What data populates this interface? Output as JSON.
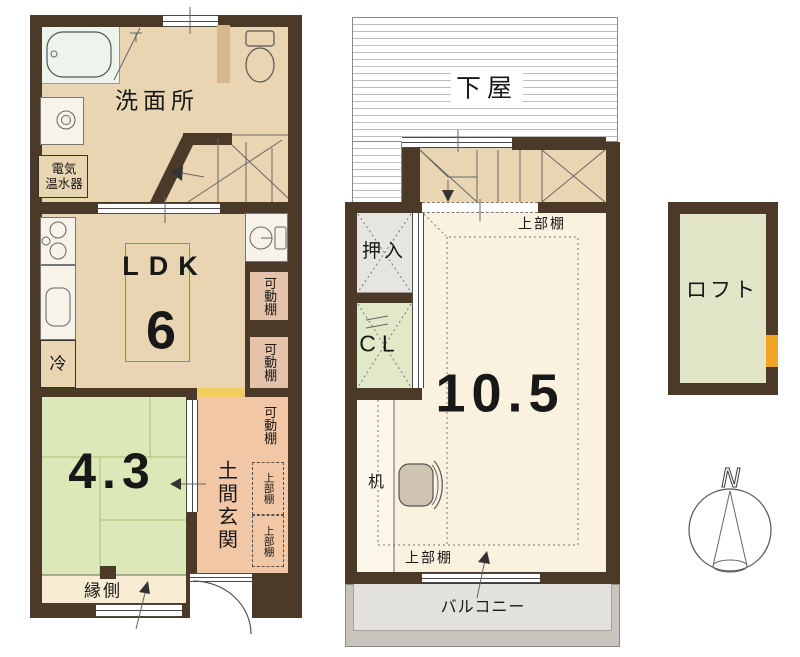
{
  "title": "2-story floor plan with loft",
  "floor1": {
    "washroom": "洗面所",
    "water_heater": {
      "line1": "電気",
      "line2": "温水器"
    },
    "ldk_label": "LDK",
    "ldk_size": "6",
    "fridge": "冷",
    "movable_shelves": [
      "可動棚",
      "可動棚",
      "可動棚"
    ],
    "tatami_size": "4.3",
    "entrance": "土間玄関",
    "upper_shelves": [
      "上部棚",
      "上部棚"
    ],
    "veranda": "縁側"
  },
  "floor2": {
    "lower_roof": "下屋",
    "upper_shelf_top": "上部棚",
    "closet": "押入",
    "closet_cl": "CL",
    "room_size": "10.5",
    "desk": "机",
    "upper_shelf_bottom": "上部棚",
    "balcony": "バルコニー"
  },
  "loft": {
    "label": "ロフト"
  },
  "compass": {
    "north": "N"
  },
  "colors": {
    "wall": "#4c3a28",
    "floor_tan": "#e9d5b2",
    "tatami": "#dbe9b8",
    "veranda_cream": "#f8edd3",
    "room_cream": "#faf1de",
    "entrance_salmon": "#f1c7a5",
    "shelf_pink": "#e5c3aa",
    "accent_yellow": "#f2cd66",
    "ladder_orange": "#f2a424",
    "closet_gray": "#e7e5e1",
    "cl_green": "#e1e9c9",
    "loft_sage": "#e1e4c6",
    "balcony_gray": "#c9c4bc",
    "balcony_inner": "#e2e1dd",
    "bath_white": "#eef3ec",
    "fixture_white": "#f7f3e8",
    "partition_tan": "#d5b88c"
  }
}
